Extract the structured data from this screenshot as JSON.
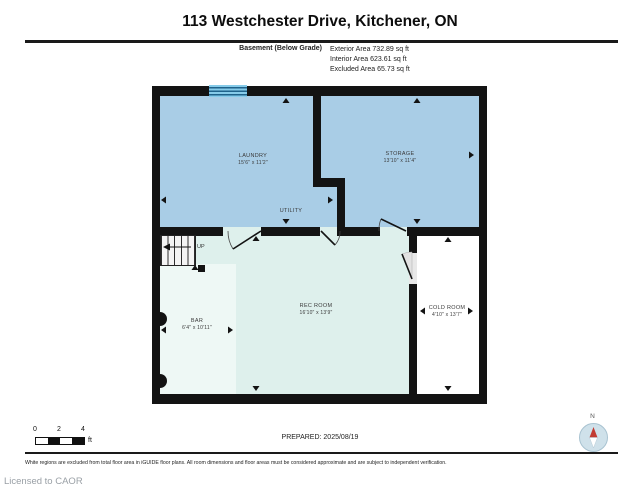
{
  "header": {
    "title": "113 Westchester Drive, Kitchener, ON",
    "floor_label": "Basement (Below Grade)",
    "area_lines": [
      "Exterior Area 732.89 sq ft",
      "Interior Area 623.61 sq ft",
      "Excluded Area 65.73 sq ft"
    ]
  },
  "rooms": [
    {
      "name": "LAUNDRY",
      "dims": "15'6\" x 11'2\""
    },
    {
      "name": "STORAGE",
      "dims": "13'10\" x 11'4\""
    },
    {
      "name": "UTILITY",
      "dims": ""
    },
    {
      "name": "REC ROOM",
      "dims": "16'10\" x 13'9\""
    },
    {
      "name": "BAR",
      "dims": "6'4\" x 10'11\""
    },
    {
      "name": "COLD ROOM",
      "dims": "4'10\" x 13'7\""
    }
  ],
  "stairs": {
    "label": "UP"
  },
  "scale_bar": {
    "ticks": [
      "0",
      "2",
      "4"
    ],
    "unit": "ft"
  },
  "compass": {
    "north_label": "N"
  },
  "footer": {
    "prepared": "PREPARED: 2025/08/19",
    "disclaimer": "White regions are excluded from total floor area in iGUIDE floor plans. All room dimensions and floor areas must be considered approximate and are subject to independent verification.",
    "license": "Licensed to CAOR"
  },
  "colors": {
    "wall": "#131313",
    "room_blue": "#a9cde6",
    "room_mint": "#def0ec",
    "room_bar": "#eef8f5",
    "room_excluded": "#ffffff",
    "window_blue": "#86cbe9",
    "compass_red": "#c23b33"
  }
}
